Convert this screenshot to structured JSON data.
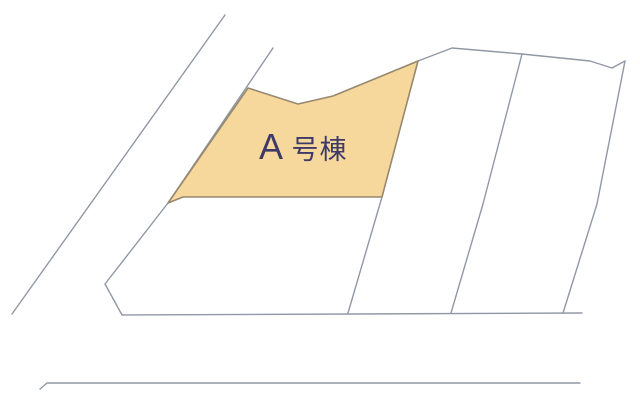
{
  "canvas": {
    "width": 640,
    "height": 407,
    "background": "#ffffff"
  },
  "colors": {
    "boundary_line": "#9098A6",
    "lot_fill": "#F6D79C",
    "lot_stroke": "#97886F",
    "label_text": "#3E3A68"
  },
  "lot": {
    "label": "A号棟",
    "points": "248,88 298,104 333,96 418,61 382,197 183,197 168,203"
  },
  "label": {
    "latin": "A",
    "kanji": "号棟",
    "x": 259,
    "y": 159,
    "latin_size": 36,
    "kanji_size": 27
  },
  "boundaries": [
    {
      "name": "road-upper-left-line",
      "points": "225,15 12,314"
    },
    {
      "name": "west-boundary-and-south-road-line",
      "points": "273,48 168,203 105,284 122,315 582,313"
    },
    {
      "name": "north-boundary-line",
      "points": "418,61 452,48 522,54 590,61 612,68 625,61"
    },
    {
      "name": "parcel-divider-line-1",
      "points": "522,54 483,204 451,313"
    },
    {
      "name": "parcel-divider-line-2",
      "points": "625,61 597,204 563,313"
    },
    {
      "name": "lot-east-extension-line",
      "points": "382,197 348,313"
    },
    {
      "name": "south-road-line",
      "points": "40,389 47,383 580,383"
    }
  ]
}
